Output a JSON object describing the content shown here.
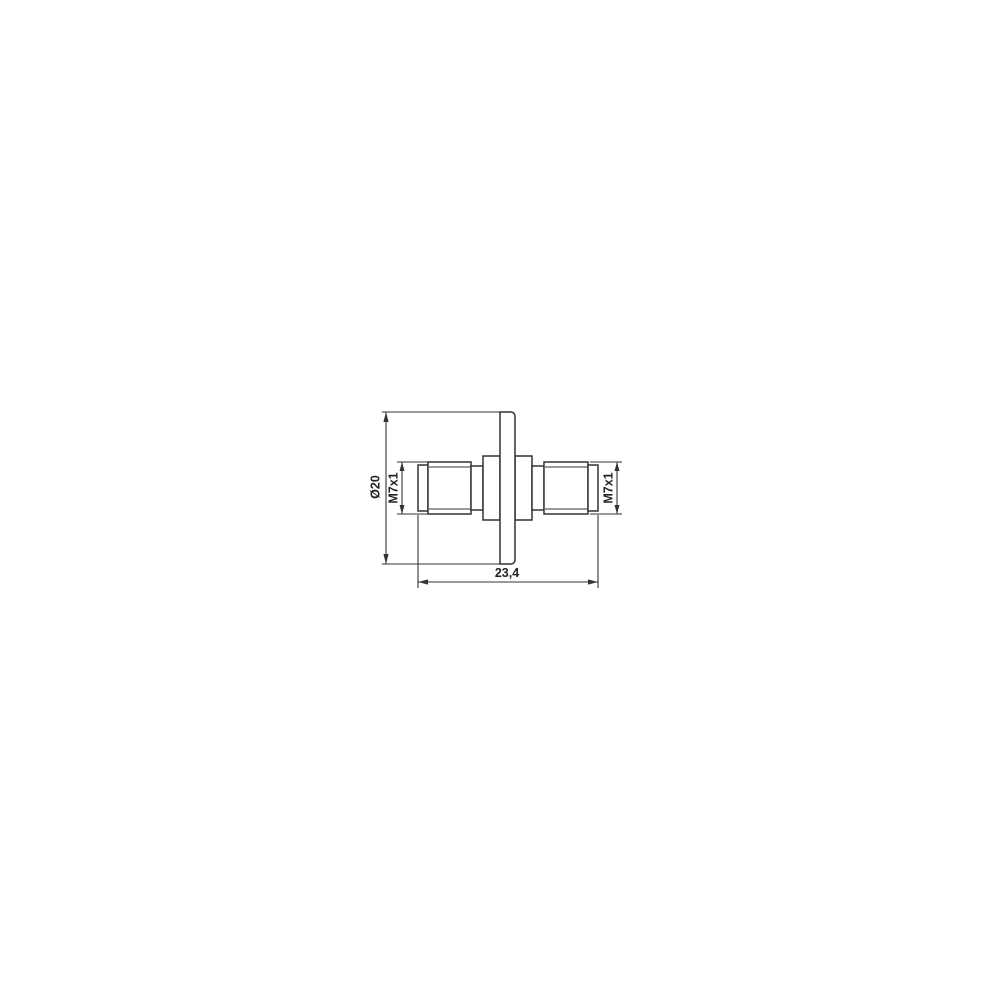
{
  "drawing": {
    "labels": {
      "flange_diameter": "Ø20",
      "thread_left": "M7x1",
      "thread_right": "M7x1",
      "overall_length": "23,4"
    },
    "colors": {
      "line": "#333333",
      "background": "#ffffff"
    }
  }
}
